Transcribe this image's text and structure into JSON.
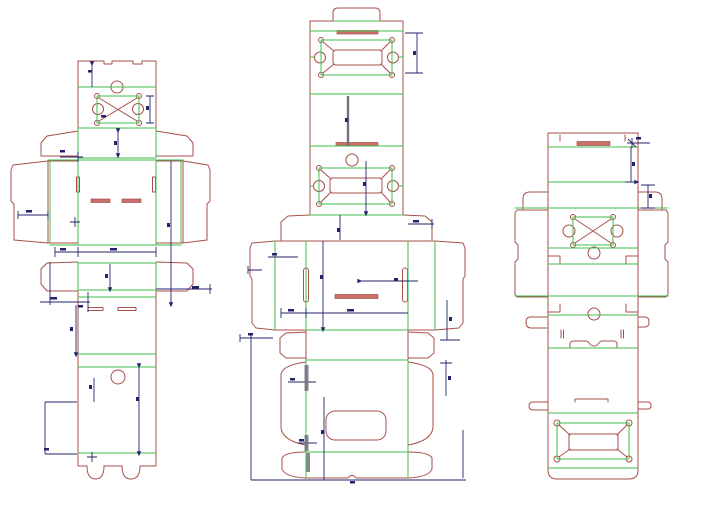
{
  "page": {
    "background_color": "#ffffff",
    "canvas_width": 720,
    "canvas_height": 514
  },
  "palette": {
    "cut_line": "#a84f4a",
    "crease_line": "#3fbf4c",
    "dimension_line": "#23236b",
    "slot_fill": "#c9706a",
    "thick_dimension": "#70707e"
  }
}
